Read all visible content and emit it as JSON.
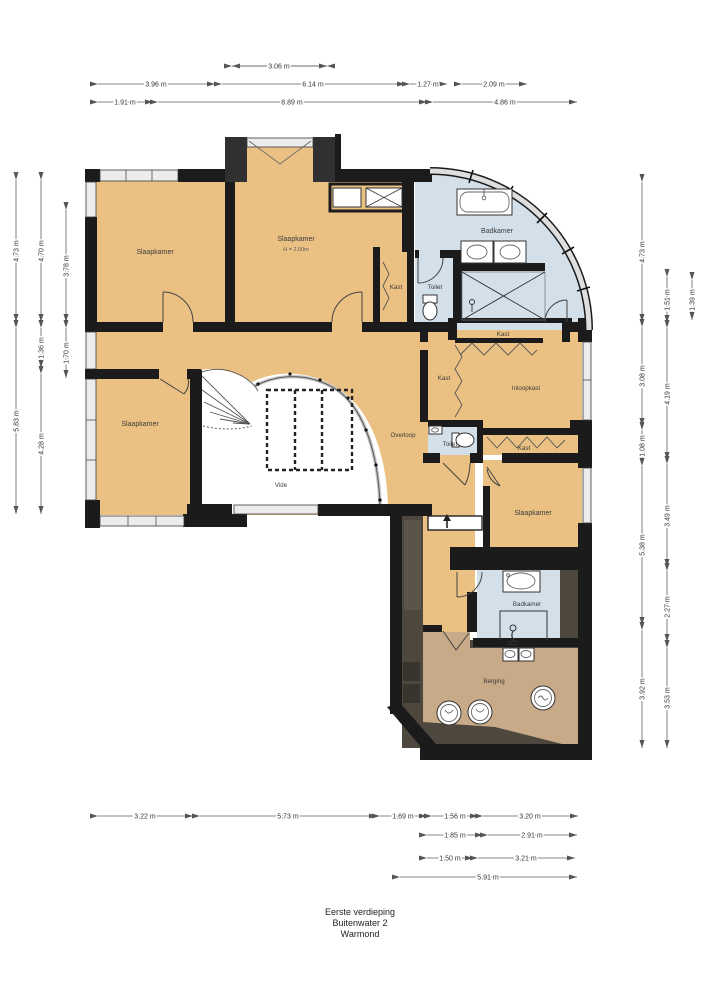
{
  "title": {
    "line1": "Eerste verdieping",
    "line2": "Buitenwater 2",
    "line3": "Warmond"
  },
  "rooms": {
    "slaapkamer_tl": "Slaapkamer",
    "slaapkamer_tm": "Slaapkamer",
    "slaapkamer_tm_height": "H = 2.00m",
    "badkamer_top": "Badkamer",
    "kast_top_strip": "Kast",
    "toilet_top": "Toilet",
    "kast_mid": "Kast",
    "kast_left": "Kast",
    "inloopkast": "Inloopkast",
    "toilet_mid": "Toilet",
    "kast_bottom": "Kast",
    "overloop": "Overloop",
    "vide": "Vide",
    "slaapkamer_bl": "Slaapkamer",
    "slaapkamer_br": "Slaapkamer",
    "badkamer_bottom": "Badkamer",
    "berging": "Berging"
  },
  "dimensions": {
    "top": [
      "3.06 m",
      "3.96 m",
      "6.14 m",
      "1.27 m",
      "2.09 m",
      "1.91 m",
      "8.89 m",
      "4.86 m"
    ],
    "left": [
      "4.73 m",
      "5.83 m",
      "4.70 m",
      "1.36 m",
      "4.28 m",
      "3.78 m",
      "1.70 m"
    ],
    "right": [
      "4.73 m",
      "3.08 m",
      "1.08 m",
      "5.38 m",
      "3.92 m",
      "1.51 m",
      "4.19 m",
      "3.49 m",
      "2.27 m",
      "3.53 m",
      "1.39 m"
    ],
    "bottom": [
      "3.22 m",
      "5.73 m",
      "1.69 m",
      "1.56 m",
      "3.20 m",
      "1.85 m",
      "2.91 m",
      "1.50 m",
      "3.21 m",
      "5.91 m"
    ]
  },
  "colors": {
    "room_tan": "#ebc183",
    "bath_blue": "#d3dfe9",
    "berging_tan": "#c9aa88",
    "dark_zone": "#4e473d",
    "wall_black": "#1b1b1b",
    "window_gray": "#ececec"
  }
}
